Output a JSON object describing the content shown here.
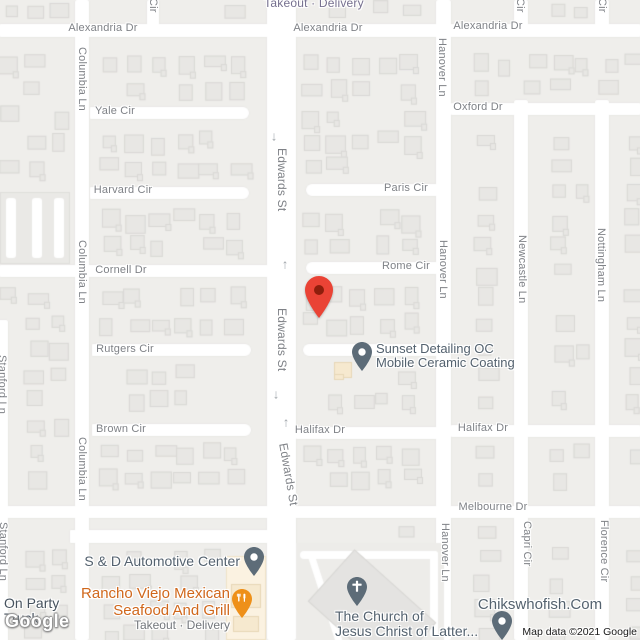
{
  "map": {
    "watermark": "Google",
    "attribution": "Map data ©2021 Google",
    "colors": {
      "road": "#FFFFFF",
      "block": "#EFEEEB",
      "building": "#E8E7E4",
      "commercial_area": "#FBF2E1",
      "street_label": "#7F8287",
      "poi_label": "#54626F",
      "poi_pin": "#5D6C78",
      "restaurant_label": "#D0671B",
      "restaurant_pin": "#EE9019",
      "destination_pin": "#EA4335",
      "secondary_label": "#74797E"
    },
    "street_labels": [
      {
        "t": "Takeout · Delivery",
        "x": 314,
        "y": 3,
        "s": 12,
        "c": "#76708F"
      },
      {
        "t": "Alexandria Dr",
        "x": 103,
        "y": 28
      },
      {
        "t": "Alexandria Dr",
        "x": 328,
        "y": 28
      },
      {
        "t": "Alexandria Dr",
        "x": 488,
        "y": 26
      },
      {
        "t": "Cir",
        "x": 153,
        "y": -2,
        "o": "v"
      },
      {
        "t": "Cir",
        "x": 520,
        "y": -2,
        "o": "v"
      },
      {
        "t": "Cir",
        "x": 602,
        "y": -2,
        "o": "v"
      },
      {
        "t": "Columbia Ln",
        "x": 82,
        "y": 47,
        "o": "v"
      },
      {
        "t": "Yale Cir",
        "x": 115,
        "y": 111
      },
      {
        "t": "Oxford Dr",
        "x": 478,
        "y": 107
      },
      {
        "t": "Hanover Ln",
        "x": 442,
        "y": 38,
        "o": "v"
      },
      {
        "t": "Harvard Cir",
        "x": 123,
        "y": 190
      },
      {
        "t": "Paris Cir",
        "x": 406,
        "y": 188
      },
      {
        "t": "Edwards St",
        "x": 283,
        "y": 148,
        "o": "v",
        "s": 12
      },
      {
        "t": "Cornell Dr",
        "x": 121,
        "y": 270
      },
      {
        "t": "Rome Cir",
        "x": 406,
        "y": 266
      },
      {
        "t": "Columbia Ln",
        "x": 82,
        "y": 240,
        "o": "v"
      },
      {
        "t": "Hanover Ln",
        "x": 443,
        "y": 240,
        "o": "v"
      },
      {
        "t": "Newcastle Ln",
        "x": 522,
        "y": 235,
        "o": "v"
      },
      {
        "t": "Nottingham Ln",
        "x": 601,
        "y": 228,
        "o": "v"
      },
      {
        "t": "Edwards St",
        "x": 283,
        "y": 308,
        "o": "v",
        "s": 12
      },
      {
        "t": "Rutgers Cir",
        "x": 125,
        "y": 349
      },
      {
        "t": "Stanford Ln",
        "x": 2,
        "y": 355,
        "o": "v"
      },
      {
        "t": "Brown Cir",
        "x": 121,
        "y": 429
      },
      {
        "t": "Columbia Ln",
        "x": 82,
        "y": 437,
        "o": "v"
      },
      {
        "t": "Halifax Dr",
        "x": 320,
        "y": 430
      },
      {
        "t": "Halifax Dr",
        "x": 483,
        "y": 428
      },
      {
        "t": "Edwards St",
        "x": 284,
        "y": 442,
        "o": "v",
        "s": 12,
        "r": 80
      },
      {
        "t": "Melbourne Dr",
        "x": 493,
        "y": 507
      },
      {
        "t": "Stanford Ln",
        "x": 3,
        "y": 522,
        "o": "v"
      },
      {
        "t": "Hanover Ln",
        "x": 445,
        "y": 523,
        "o": "v"
      },
      {
        "t": "Capri Cir",
        "x": 527,
        "y": 521,
        "o": "v"
      },
      {
        "t": "Florence Cir",
        "x": 604,
        "y": 520,
        "o": "v"
      }
    ],
    "arrows": [
      {
        "x": 274,
        "y": 136,
        "dir": "down"
      },
      {
        "x": 285,
        "y": 264,
        "dir": "up"
      },
      {
        "x": 276,
        "y": 394,
        "dir": "down"
      },
      {
        "x": 286,
        "y": 422,
        "dir": "up"
      }
    ],
    "destination_pin": {
      "x": 319,
      "y": 317,
      "color": "#EA4335"
    },
    "pois": [
      {
        "id": "sunset-detailing",
        "icon": "location-pin",
        "pin": {
          "x": 352,
          "y": 342
        },
        "pin_color": "#5D6C78",
        "text": {
          "x": 376,
          "y": 342,
          "align": "left",
          "size": 13
        },
        "lines": [
          "Sunset Detailing OC",
          "Mobile Ceramic Coating"
        ]
      },
      {
        "id": "s-and-d-automotive",
        "icon": "location-pin",
        "pin": {
          "x": 244,
          "y": 547
        },
        "pin_color": "#5D6C78",
        "text": {
          "x": 240,
          "y": 554,
          "align": "right",
          "size": 14
        },
        "lines": [
          "S & D Automotive Center"
        ]
      },
      {
        "id": "rancho-viejo-mexican",
        "icon": "restaurant-pin",
        "pin": {
          "x": 232,
          "y": 589
        },
        "pin_color": "#EE9019",
        "text": {
          "x": 230,
          "y": 586,
          "align": "right",
          "size": 15,
          "color": "#D0671B"
        },
        "lines": [
          "Rancho Viejo Mexican",
          "Seafood And Grill"
        ],
        "sub": "Takeout · Delivery"
      },
      {
        "id": "church-of-jesus-christ",
        "icon": "church-pin",
        "pin": {
          "x": 347,
          "y": 577
        },
        "pin_color": "#5D6C78",
        "text": {
          "x": 335,
          "y": 609,
          "align": "left",
          "size": 14
        },
        "lines": [
          "The Church of",
          "Jesus Christ of Latter..."
        ]
      },
      {
        "id": "chikswhofish",
        "icon": "location-pin",
        "pin": {
          "x": 492,
          "y": 611
        },
        "pin_color": "#5D6C78",
        "text": {
          "x": 540,
          "y": 597,
          "align": "center",
          "size": 15
        },
        "lines": [
          "Chikswhofish.Com"
        ]
      },
      {
        "id": "on-party-truck",
        "icon": null,
        "text": {
          "x": 4,
          "y": 596,
          "align": "left",
          "size": 14,
          "color": "#46525E"
        },
        "lines": [
          "On Party",
          "Truck"
        ]
      }
    ]
  }
}
